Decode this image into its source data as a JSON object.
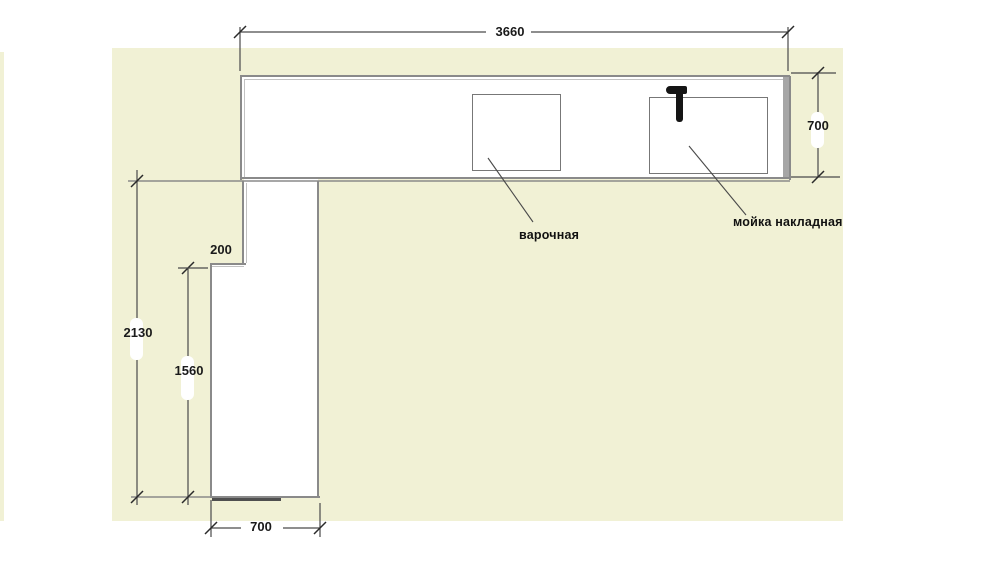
{
  "dims": {
    "top_width": "3660",
    "right_depth": "700",
    "left_total_height": "2130",
    "left_lower_height": "1560",
    "step_width": "200",
    "bottom_width": "700"
  },
  "labels": {
    "cooktop": "варочная",
    "sink": "мойка накладная"
  },
  "colors": {
    "page_bg": "#ffffff",
    "panel_bg": "#f1f1d5",
    "outline": "#8a8a8a",
    "dim_line": "#4a4a4a",
    "tick": "#2a2a2a",
    "text": "#1a1a1a",
    "fixture_outline": "#777777",
    "faucet": "#151515"
  }
}
